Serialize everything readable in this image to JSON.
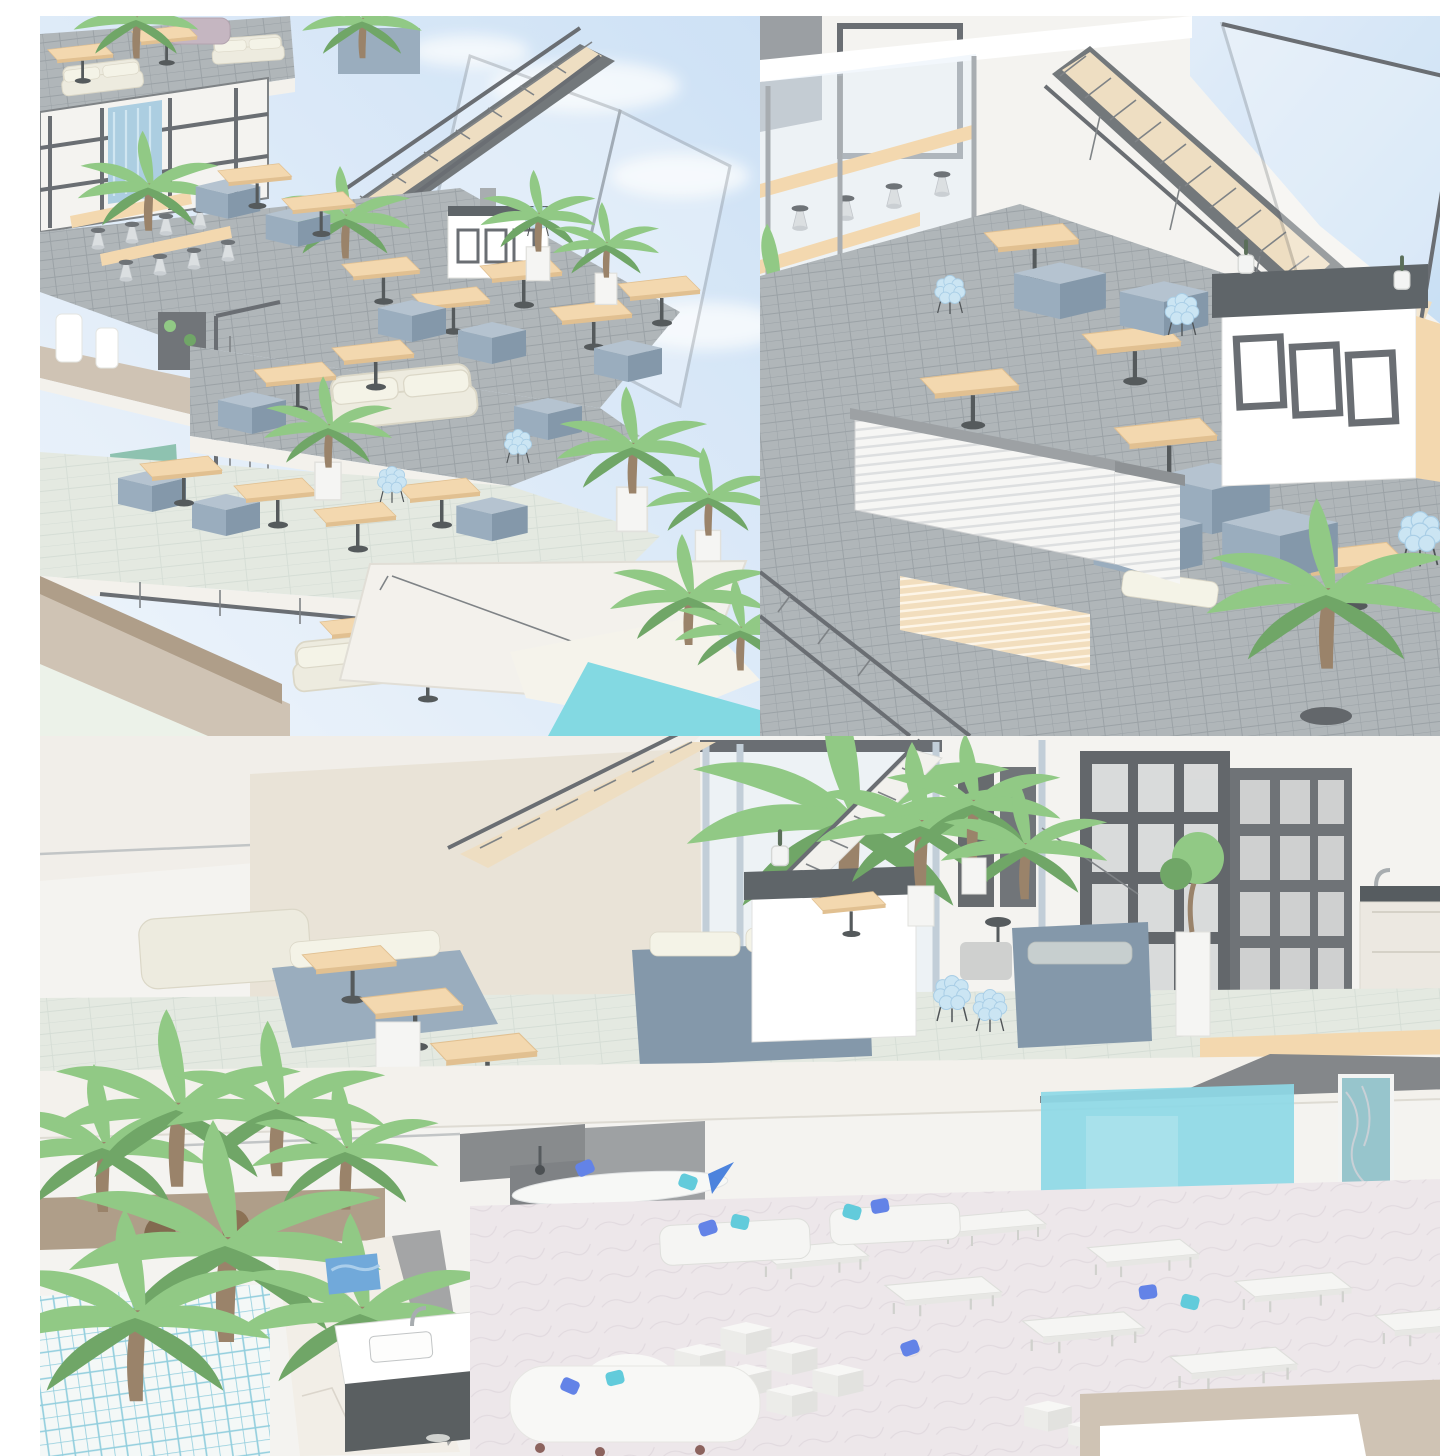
{
  "panels": [
    {
      "id": "overview",
      "label": "Bird's-eye cutaway render of a terraced multi-level cafe building with palm plants, staircase, canopy roof and pool"
    },
    {
      "id": "topfloor",
      "label": "Close-up render of the top-floor cafe: wooden staircase, glass wall with bar stools, wood tables, blue booth seating, bar counter with champagne buckets and palm"
    },
    {
      "id": "crosssection",
      "label": "Wide cross-section render of two floors: upper lounge with blue sofas, bar island, grid shelving and kitchen; lower lounge with white sofas, blue pillows, aqua accent wall, palms and kitchen sink"
    }
  ],
  "palette": {
    "sky1": "#e9f2fb",
    "sky2": "#c6ddf4",
    "cloud": "#f7fafd",
    "wallWhite": "#f3f2ee",
    "wallBeige": "#e6dfd1",
    "ceiling": "#efece6",
    "glass": "#e3eef9",
    "fascia": "#f1efe9",
    "frame": "#6a6f73",
    "frameDark": "#52575c",
    "steel": "#b9c6d2",
    "tile": "#a3aaae",
    "grout": "#8b9398",
    "marble": "#e0e6dd",
    "marbleLine": "#cfd8cf",
    "pinkFloor": "#eae3e7",
    "pinkVein": "#dcd3d9",
    "poolTileLine": "#7fc6d8",
    "wood": "#f2d2a2",
    "woodEdge": "#dcb67f",
    "stairWood": "#ecd9b8",
    "booth": "#8aa0b4",
    "boothLight": "#a9bac9",
    "boothDark": "#70889c",
    "cream": "#ebe8da",
    "creamDark": "#d5d1be",
    "green": "#7fc172",
    "greenDark": "#59984f",
    "trunk": "#8a6f52",
    "pool": "#6fd3de",
    "aqua": "#7cd3e3",
    "tealArt": "#86bcc4",
    "sand": "#f4f1e8",
    "tan": "#c8baa8",
    "brown": "#a28e76",
    "cutGray": "#8f9294",
    "cutGrayDark": "#75787b",
    "soffit": "#707477",
    "counterTop": "#454c51",
    "blue": "#4a6fe3",
    "cyan": "#49c3d5",
    "chairBlue": "#c3e1f2",
    "chairBlueEdge": "#9bc6e2",
    "offWhite": "#f0efeb"
  }
}
